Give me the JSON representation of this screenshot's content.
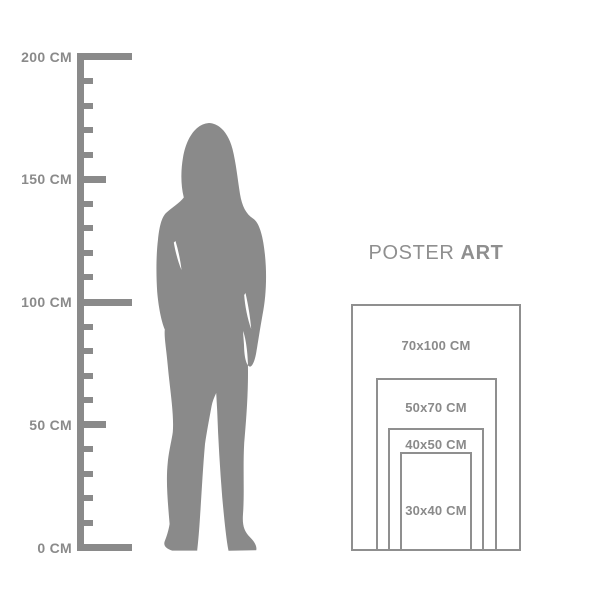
{
  "colors": {
    "ink": "#8a8a8a",
    "frame": "#8f8f8f",
    "heading": "#8f8f8f",
    "background": "#ffffff"
  },
  "heading": {
    "regular": "POSTER",
    "bold": "ART"
  },
  "ruler": {
    "unit": "CM",
    "max_cm": 200,
    "minor_step_cm": 10,
    "label_step_cm": 50,
    "labels": [
      {
        "text": "200 CM",
        "cm": 200
      },
      {
        "text": "150 CM",
        "cm": 150
      },
      {
        "text": "100 CM",
        "cm": 100
      },
      {
        "text": "50 CM",
        "cm": 50
      },
      {
        "text": "0 CM",
        "cm": 0
      }
    ]
  },
  "figure": {
    "name": "standing woman silhouette"
  },
  "posters": [
    {
      "label": "70x100 CM",
      "width_cm": 70,
      "height_cm": 100
    },
    {
      "label": "50x70 CM",
      "width_cm": 50,
      "height_cm": 70
    },
    {
      "label": "40x50 CM",
      "width_cm": 40,
      "height_cm": 50
    },
    {
      "label": "30x40 CM",
      "width_cm": 30,
      "height_cm": 40
    }
  ]
}
